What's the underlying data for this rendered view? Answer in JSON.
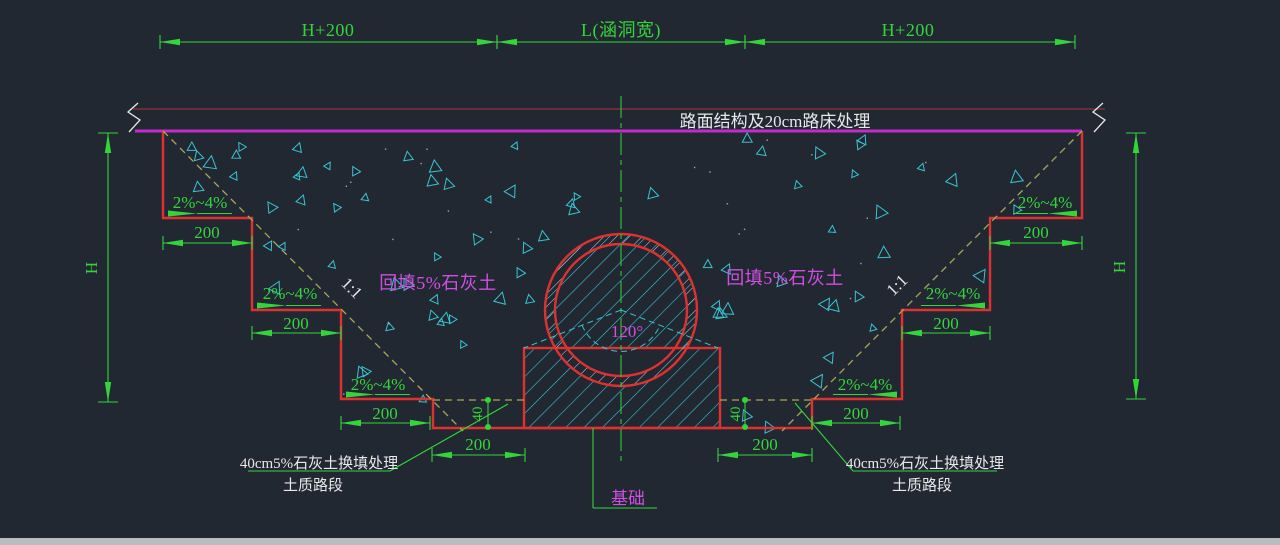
{
  "colors": {
    "bg": "#212832",
    "green": "#35d43c",
    "red": "#e03131",
    "magenta": "#c32cc9",
    "mtext": "#cf4fe0",
    "white": "#e6e9ec",
    "olive": "#a8a85c",
    "cyan": "#3bc3d0",
    "maroon": "#643036",
    "scroll": "#b9bdc2"
  },
  "labels": {
    "h_plus_200": "H+200",
    "culvert_width": "L(涵洞宽)",
    "road_note": "路面结构及20cm路床处理",
    "h": "H",
    "slope_pct": "2%~4%",
    "d200": "200",
    "d40": "40",
    "ratio": "1:1",
    "backfill": "回填5%石灰土",
    "angle": "120°",
    "foundation": "基础",
    "replace_note_line1": "40cm5%石灰土换填处理",
    "replace_note_line2": "土质路段"
  }
}
